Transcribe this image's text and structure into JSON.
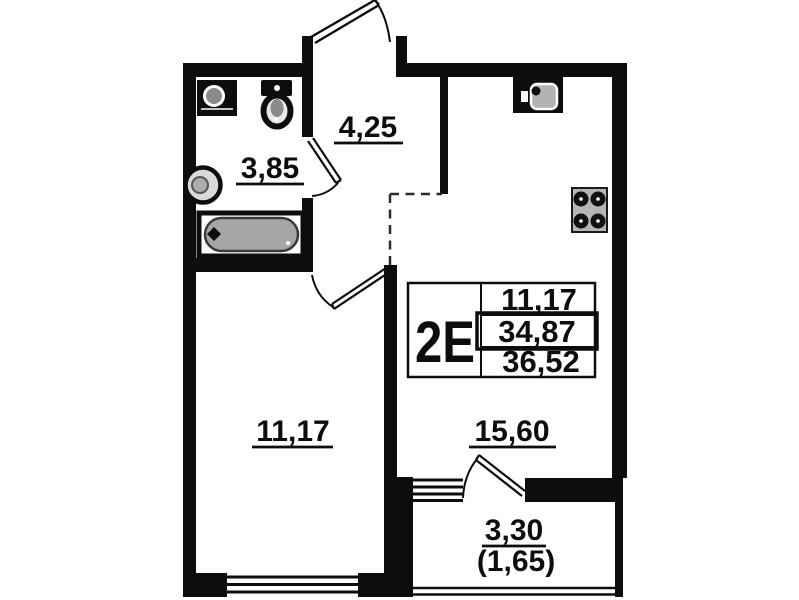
{
  "unit": {
    "type_label": "2E",
    "area_rows": [
      "11,17",
      "34,87",
      "36,52"
    ]
  },
  "rooms": {
    "bathroom": "3,85",
    "hallway": "4,25",
    "living_room": "11,17",
    "kitchen_living": "15,60",
    "balcony_full": "3,30",
    "balcony_reduced": "(1,65)"
  },
  "icons": [
    "bathroom-sink-icon",
    "toilet-icon",
    "washbasin-icon",
    "bathtub-icon",
    "kitchen-sink-icon",
    "stove-icon",
    "entrance-door-swing",
    "bathroom-door-swing",
    "room-door-swing",
    "balcony-door-swing",
    "window-glyph",
    "zone-dashed-boundary"
  ],
  "colors": {
    "wall": "#0d0d0d",
    "background": "#ffffff",
    "bathtub_fill": "#a6a6a6",
    "stove_fill": "#b5b5b5",
    "fixture_gray": "#8a8a8a"
  }
}
